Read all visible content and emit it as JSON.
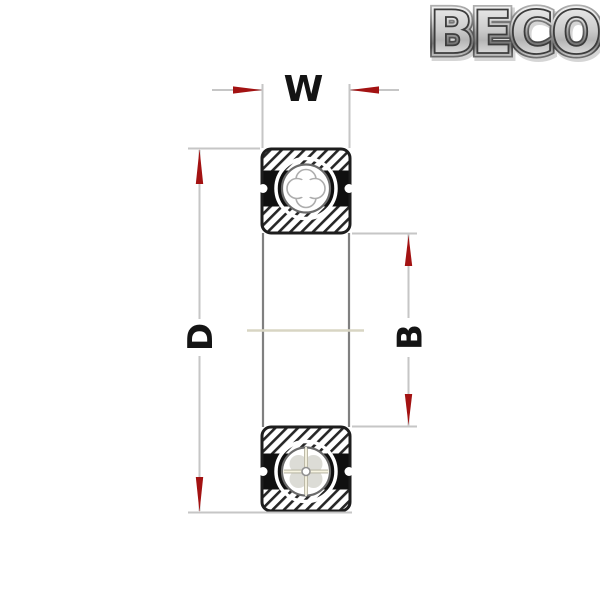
{
  "logo": {
    "text": "BECO"
  },
  "diagram": {
    "type": "ball-bearing-cross-section-drawing",
    "dimensions": {
      "w": {
        "label": "W",
        "meaning": "bearing width"
      },
      "d": {
        "label": "D",
        "meaning": "outer diameter"
      },
      "b": {
        "label": "B",
        "meaning": "bore diameter"
      }
    }
  },
  "colors": {
    "background": "#ffffff",
    "drawing_line": "#1d1d1d",
    "hatch_line": "#262626",
    "seal_fill": "#101010",
    "secondary_line": "#808080",
    "extension_line": "#c6c6c6",
    "centerline": "#d8d5c3",
    "arrow_red": "#a31212",
    "label_text": "#141414",
    "ball_outline": "#6a6a6a"
  }
}
